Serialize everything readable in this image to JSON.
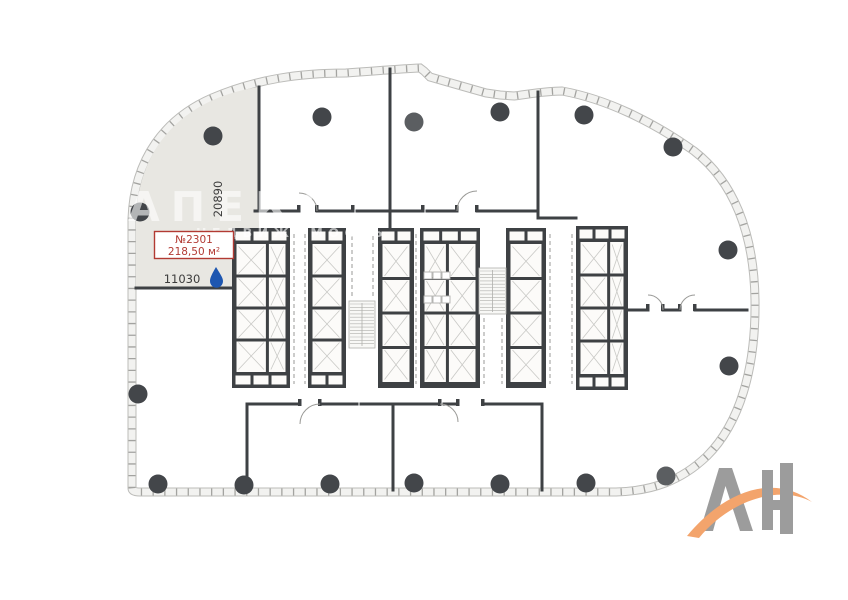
{
  "page": {
    "background": "#ffffff"
  },
  "unit": {
    "number": "№2301",
    "area": "218,50 м²",
    "dim_width": "11030",
    "dim_height": "20890"
  },
  "watermark": {
    "line1": "АПЕКС",
    "line2": "НЕДВИЖИМОСТЬ"
  },
  "logo": {
    "text": "АН"
  },
  "colors": {
    "wall": "#3e4144",
    "column": "#43464a",
    "column_light": "#5b5e61",
    "envelope_edge": "#bcbcb9",
    "envelope_fill": "#f2f2f0",
    "envelope_tick": "#a3a3a0",
    "unit_fill": "#e8e7e2",
    "core_inner": "#fcfbf9",
    "cell_line": "#c9c9c6",
    "hatch": "#b0b0ad",
    "dash_line": "#9a9a97",
    "accent_red": "#b23a33",
    "dim_text": "#3c3c3c",
    "drop_blue": "#1d56b0",
    "logo_gray": "#9c9c9c",
    "logo_orange": "#f3a46c",
    "watermark": "rgba(255,255,255,0.6)"
  },
  "plan": {
    "envelope_path": "M 132 488 L 132 219 C 134 158 166 118 212 98 C 256 79 300 73 346 73 C 372 71 398 69 420 68 L 424 71 L 430 77 L 444 81 L 458 85 L 472 89 L 486 93 L 500 95 L 514 96 C 530 94 546 91 562 91 C 606 99 652 121 694 151 C 733 181 754 232 755 300 C 756 370 739 424 707 456 C 681 481 652 491 616 492 L 140 492 Q 132 492 132 488 Z",
    "unit_path": "M 136 288 L 136 219 C 138 160 168 120 213 100 C 229 93 245 89 259 87 L 259 228 L 232 228 L 232 288 Z",
    "walls": [
      [
        259,
        87,
        259,
        211
      ],
      [
        136,
        288,
        232,
        288
      ],
      [
        390,
        69,
        390,
        228
      ],
      [
        538,
        92,
        538,
        211
      ],
      [
        255,
        211,
        299,
        211
      ],
      [
        317,
        211,
        353,
        211
      ],
      [
        357,
        211,
        423,
        211
      ],
      [
        427,
        211,
        457,
        211
      ],
      [
        477,
        211,
        538,
        211
      ],
      [
        538,
        211,
        538,
        218
      ],
      [
        538,
        218,
        576,
        218
      ],
      [
        247,
        404,
        300,
        404
      ],
      [
        320,
        404,
        357,
        404
      ],
      [
        361,
        404,
        440,
        404
      ],
      [
        444,
        404,
        458,
        404
      ],
      [
        483,
        404,
        542,
        404
      ],
      [
        247,
        404,
        247,
        490
      ],
      [
        393,
        404,
        393,
        490
      ],
      [
        542,
        404,
        542,
        490
      ],
      [
        628,
        310,
        648,
        310
      ],
      [
        663,
        310,
        680,
        310
      ],
      [
        695,
        310,
        747,
        310
      ]
    ],
    "posts": [
      [
        297,
        205
      ],
      [
        315,
        205
      ],
      [
        351,
        205
      ],
      [
        421,
        205
      ],
      [
        455,
        205
      ],
      [
        475,
        205
      ],
      [
        298,
        399
      ],
      [
        318,
        399
      ],
      [
        438,
        399
      ],
      [
        456,
        399
      ],
      [
        481,
        399
      ],
      [
        646,
        304
      ],
      [
        661,
        304
      ],
      [
        678,
        304
      ],
      [
        693,
        304
      ]
    ],
    "banks": [
      {
        "x": 232,
        "y": 228,
        "w": 58,
        "h": 160,
        "split": 0.6,
        "bb": true
      },
      {
        "x": 308,
        "y": 228,
        "w": 38,
        "h": 160,
        "bb": true
      },
      {
        "x": 378,
        "y": 228,
        "w": 36,
        "h": 160
      },
      {
        "x": 420,
        "y": 228,
        "w": 60,
        "h": 160,
        "split": 0.42
      },
      {
        "x": 506,
        "y": 228,
        "w": 40,
        "h": 160
      },
      {
        "x": 576,
        "y": 226,
        "w": 52,
        "h": 164,
        "split": 0.62,
        "bb": true
      }
    ],
    "stairs": [
      {
        "x": 349,
        "y": 301,
        "w": 26,
        "h": 47
      },
      {
        "x": 479,
        "y": 268,
        "w": 27,
        "h": 46
      }
    ],
    "fixtures": [
      [
        424,
        272,
        8,
        7
      ],
      [
        433,
        272,
        8,
        7
      ],
      [
        442,
        272,
        8,
        7
      ],
      [
        424,
        296,
        8,
        7
      ],
      [
        433,
        296,
        8,
        7
      ],
      [
        442,
        296,
        8,
        7
      ]
    ],
    "dashed": [
      [
        294,
        234,
        294,
        384
      ],
      [
        305,
        234,
        305,
        384
      ],
      [
        352,
        236,
        352,
        298
      ],
      [
        373,
        236,
        373,
        298
      ],
      [
        484,
        318,
        484,
        384
      ],
      [
        502,
        318,
        502,
        384
      ],
      [
        550,
        234,
        550,
        384
      ],
      [
        572,
        234,
        572,
        384
      ],
      [
        416,
        234,
        416,
        384
      ]
    ],
    "arcs": [
      "M317 211 A 18 18 0 0 0 299 193",
      "M457 211 A 20 20 0 0 1 477 191",
      "M320 404 A 20 20 0 0 0 300 424",
      "M440 404 A 18 18 0 0 1 458 422",
      "M663 310 A 15 15 0 0 0 648 295",
      "M680 310 A 15 15 0 0 1 695 295"
    ],
    "columns": [
      {
        "x": 213,
        "y": 136
      },
      {
        "x": 322,
        "y": 117
      },
      {
        "x": 414,
        "y": 122,
        "light": true
      },
      {
        "x": 500,
        "y": 112
      },
      {
        "x": 584,
        "y": 115
      },
      {
        "x": 673,
        "y": 147
      },
      {
        "x": 728,
        "y": 250
      },
      {
        "x": 729,
        "y": 366
      },
      {
        "x": 140,
        "y": 212
      },
      {
        "x": 138,
        "y": 394
      },
      {
        "x": 158,
        "y": 484
      },
      {
        "x": 244,
        "y": 485
      },
      {
        "x": 330,
        "y": 484
      },
      {
        "x": 414,
        "y": 483
      },
      {
        "x": 500,
        "y": 484
      },
      {
        "x": 586,
        "y": 483
      },
      {
        "x": 666,
        "y": 476,
        "light": true
      }
    ],
    "column_radius": 9.5
  }
}
